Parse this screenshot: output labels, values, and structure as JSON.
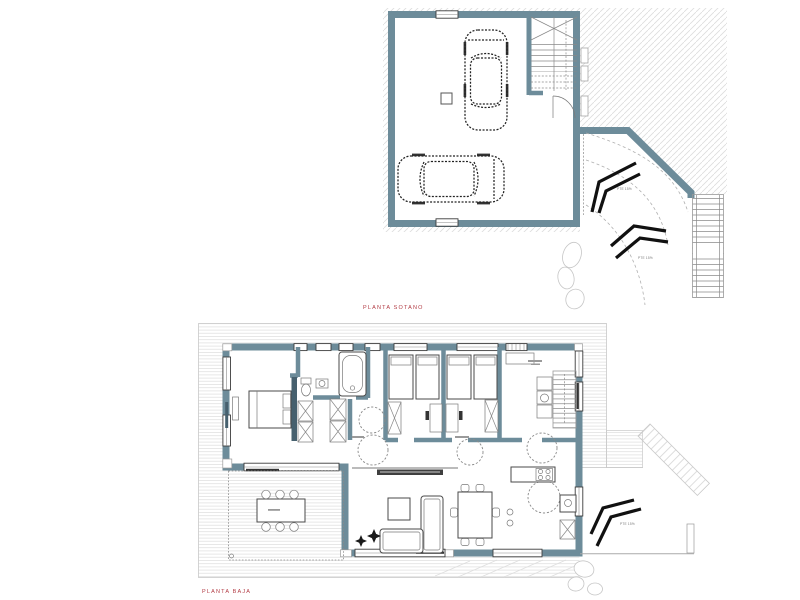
{
  "colors": {
    "paper": "#ffffff",
    "wall": "#6d8c9a",
    "wall_dark": "#46606e",
    "hatch_line": "#dcdcdc",
    "deck_line": "#dddddd",
    "drawing_line": "#4a4a4a",
    "arrow_black": "#111111",
    "label_red": "#b23b44"
  },
  "plans": [
    {
      "id": "sotano",
      "label": "PLANTA SOTANO",
      "features": [
        "garage",
        "car",
        "car",
        "stairwell",
        "utility-column",
        "garage-door",
        "access-ramp",
        "ramp-direction-arrows",
        "exterior-stairs",
        "landscape-rocks"
      ]
    },
    {
      "id": "baja",
      "label": "PLANTA BAJA",
      "features": [
        "master-bedroom",
        "bathroom",
        "wardrobes",
        "bedroom",
        "bedroom",
        "kitchen",
        "interior-stairs",
        "hallway",
        "living-room",
        "dining-table",
        "sofa",
        "tv-cabinet",
        "terrace",
        "terrace-dining-table",
        "access-ramp",
        "ramp-direction-arrows",
        "exterior-steps",
        "landscape-rocks"
      ]
    }
  ],
  "annotations": {
    "ramp_slope": "PTE 15%"
  }
}
